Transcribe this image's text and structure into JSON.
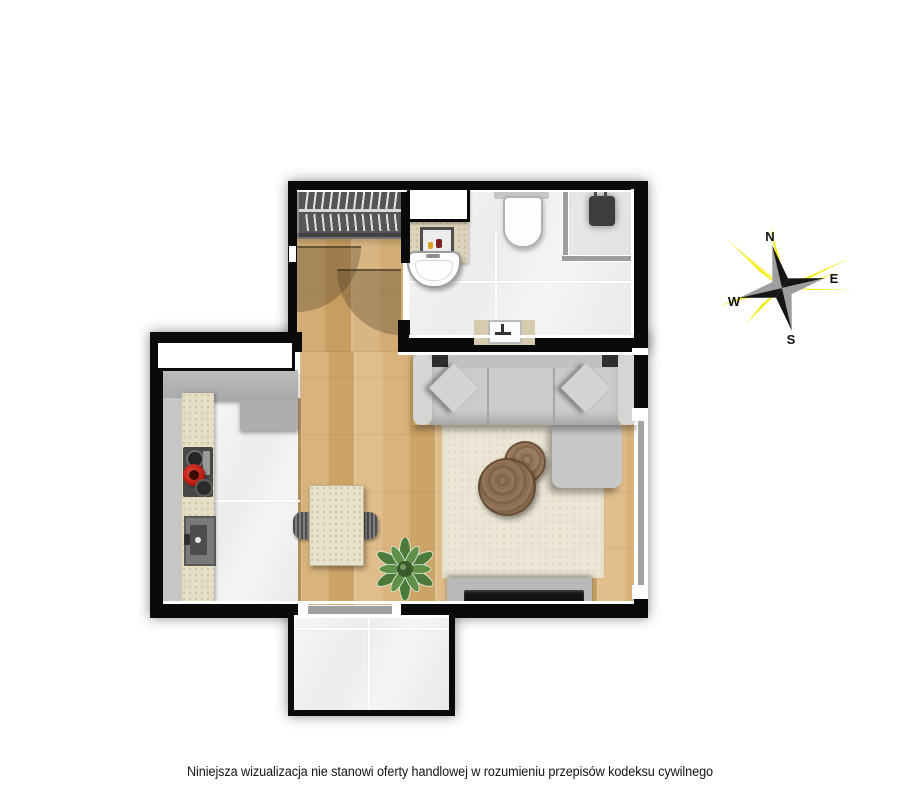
{
  "compass": {
    "n": "N",
    "e": "E",
    "s": "S",
    "w": "W"
  },
  "disclaimer": {
    "text": "Niniejsza wizualizacja nie stanowi oferty handlowej w rozumieniu przepisów kodeksu cywilnego"
  },
  "palette": {
    "wall": "#0a0a0a",
    "wood": "#d2a96e",
    "tile": "#f1f1f1",
    "sofa-gray": "#cacac8",
    "rug-cream": "#ece6d6",
    "counter-gray": "#b6b6b6",
    "counter-beige": "#e7dec6",
    "table-wood": "#8a6c4e",
    "plant-green": "#4c7a3b",
    "pot-red": "#c2281c",
    "compass-yellow": "#f4ec04"
  }
}
